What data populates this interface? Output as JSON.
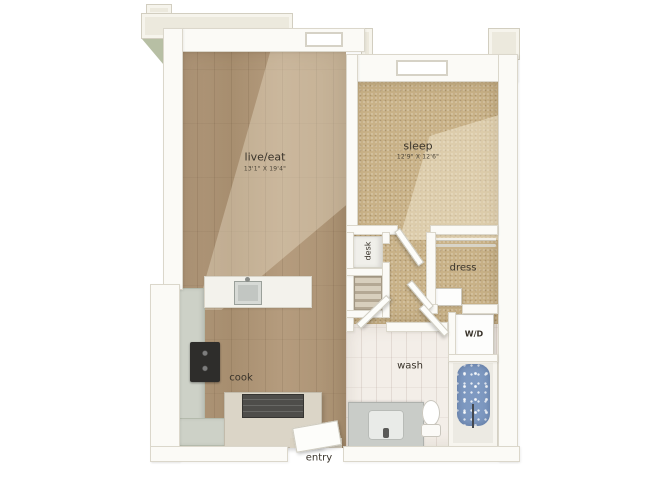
{
  "rooms": {
    "live_eat": {
      "name": "live/eat",
      "dims": "13'1\" X 19'4\""
    },
    "sleep": {
      "name": "sleep",
      "dims": "12'9\" X 12'6\""
    },
    "cook": {
      "name": "cook"
    },
    "wash": {
      "name": "wash"
    },
    "entry": {
      "name": "entry"
    },
    "dress": {
      "name": "dress"
    },
    "desk": {
      "name": "desk"
    },
    "laundry": {
      "name": "W/D"
    }
  },
  "colors": {
    "background": "#ffffff",
    "wood_floor": "#ac9273",
    "carpet": "#c9b288",
    "bath_tile": "#f3eee8",
    "wall": "#fbfaf6",
    "exterior_trim": "#ece9dd",
    "kitchen_counter": "#cdd1c7",
    "appliance_dark": "#2e2d2b",
    "tub_water": "#7e99c1",
    "roof_accent": "#b7bfa4"
  }
}
